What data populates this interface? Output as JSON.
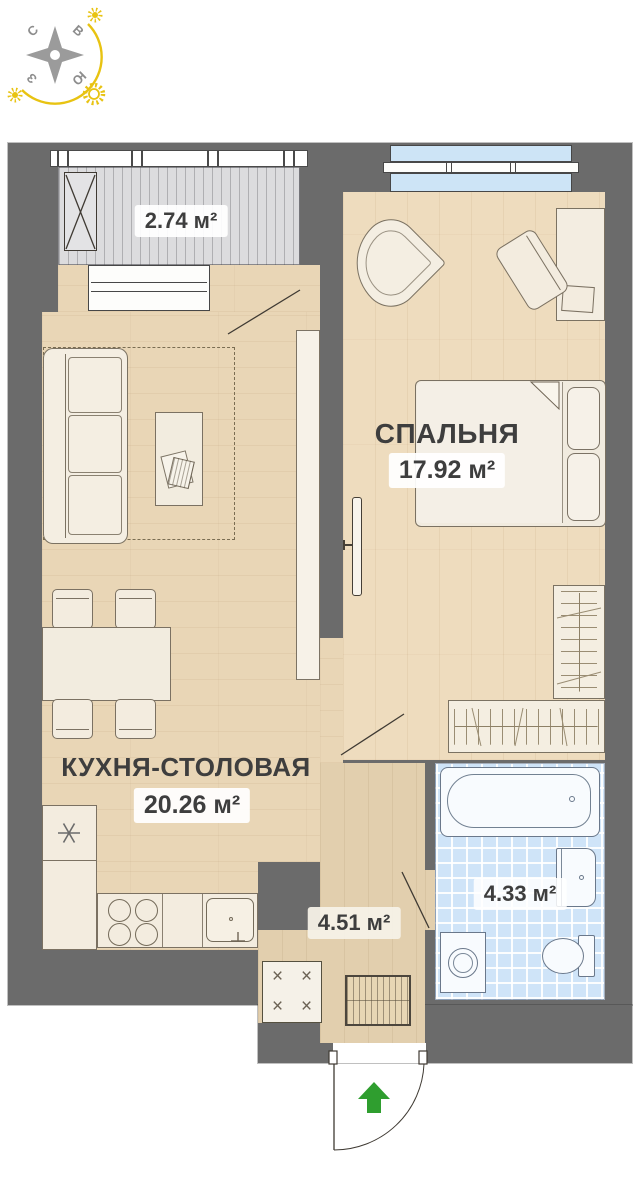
{
  "compass": {
    "north": "С",
    "east": "В",
    "west": "З",
    "south": "Ю"
  },
  "rooms": {
    "bedroom": {
      "name": "СПАЛЬНЯ",
      "area": "17.92 м²"
    },
    "kitchen": {
      "name": "КУХНЯ-СТОЛОВАЯ",
      "area": "20.26 м²"
    },
    "bathroom": {
      "area": "4.33 м²"
    },
    "hallway": {
      "area": "4.51 м²"
    },
    "balcony": {
      "area": "2.74 м²"
    }
  },
  "icons": {
    "closet_cross": "×"
  },
  "colors": {
    "wall": "#6b6b6b",
    "floor_living": "#e9d6b6",
    "floor_bedroom": "#eedcbe",
    "floor_hallway": "#e2cfae",
    "floor_balcony": "#dcdcde",
    "bathroom_tile": "#cfe4f8",
    "window_glazing": "#cde4f6",
    "entry_arrow_green": "#2f9e2f",
    "compass_yellow": "#e8c312",
    "label_text": "#3e3e3e"
  }
}
